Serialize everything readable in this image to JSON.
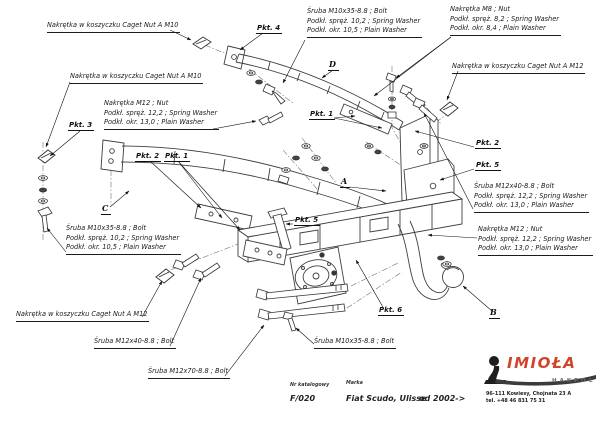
{
  "drawing": {
    "callouts": {
      "cage_nut_m10": "Nakrętka w koszyczku Caget Nut A M10",
      "cage_nut_m12": "Nakrętka w koszyczku Caget Nut A M12",
      "bolt_m10x35": {
        "l1": "Śruba M10x35-8.8 ;  Bolt",
        "l2": "Podkł. spręż. 10,2 ;  Spring Washer",
        "l3": "Podkł. okr. 10,5 ;  Plain Washer"
      },
      "bolt_m10x35_single": "Śruba M10x35-8.8  ;  Bolt",
      "bolt_m12x40": {
        "l1": "Śruba M12x40-8.8 ;  Bolt",
        "l2": "Podkł. spręż. 12,2 ;  Spring Washer",
        "l3": "Podkł. okr. 13,0 ;  Plain Washer"
      },
      "bolt_m12x40_single": "Śruba M12x40-8.8 ;  Bolt",
      "bolt_m12x70_single": "Śruba M12x70-8.8 ;  Bolt",
      "nut_m8": {
        "l1": "Nakrętka  M8 ;  Nut",
        "l2": "Podkł. spręż. 8,2 ;  Spring Washer",
        "l3": "Podkł. okr. 8,4 ;  Plain Washer"
      },
      "nut_m12": {
        "l1": "Nakrętka  M12 ;  Nut",
        "l2": "Podkł. spręż. 12,2 ;  Spring Washer",
        "l3": "Podkł. okr. 13,0 ;  Plain Washer"
      }
    },
    "points": {
      "p1": "Pkt. 1",
      "p2": "Pkt. 2",
      "p3": "Pkt. 3",
      "p4": "Pkt. 4",
      "p5": "Pkt. 5",
      "p6": "Pkt. 6"
    },
    "letters": {
      "a": "A",
      "b": "B",
      "c": "C",
      "d": "D"
    }
  },
  "title_block": {
    "catalog_label": "Nr katalogowy",
    "catalog_number": "F/020",
    "brand_label": "Marka",
    "model": "Fiat Scudo, Ulisse",
    "year_range": "od 2002->"
  },
  "logo": {
    "brand": "IMIOŁA",
    "sub_brand": "HAKPOL",
    "address_line1": "96-111 Kowiesy, Chojnata 23 A",
    "address_line2": "tel. +48 46 831 75 31"
  }
}
